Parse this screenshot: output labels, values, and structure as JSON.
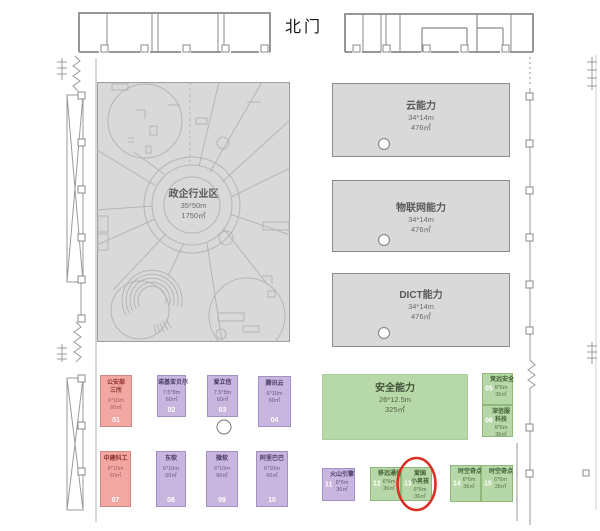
{
  "labels": {
    "north_gate": "北门"
  },
  "zones": {
    "gov": {
      "name": "政企行业区",
      "size": "35*50m",
      "area": "1750㎡"
    },
    "cloud": {
      "name": "云能力",
      "size": "34*14m",
      "area": "476㎡"
    },
    "iot": {
      "name": "物联网能力",
      "size": "34*14m",
      "area": "476㎡"
    },
    "dict": {
      "name": "DICT能力",
      "size": "34*14m",
      "area": "476㎡"
    },
    "security": {
      "name": "安全能力",
      "size": "26*12.5m",
      "area": "325㎡"
    }
  },
  "booths": [
    {
      "num": "01",
      "lines": [
        "公安部",
        "三所"
      ],
      "size": "6*10m",
      "area": "60㎡",
      "color_key": "pink"
    },
    {
      "num": "02",
      "lines": [
        "诺基亚贝尔",
        ""
      ],
      "size": "7.5*8m",
      "area": "60㎡",
      "color_key": "purple"
    },
    {
      "num": "03",
      "lines": [
        "爱立信",
        ""
      ],
      "size": "7.5*8m",
      "area": "60㎡",
      "color_key": "purple"
    },
    {
      "num": "04",
      "lines": [
        "腾讯云",
        ""
      ],
      "size": "6*10m",
      "area": "60㎡",
      "color_key": "purple"
    },
    {
      "num": "05",
      "lines": [
        "竞远安全",
        ""
      ],
      "size": "6*6m",
      "area": "36㎡",
      "color_key": "green"
    },
    {
      "num": "06",
      "lines": [
        "深信服",
        "科技"
      ],
      "size": "6*6m",
      "area": "36㎡",
      "color_key": "green"
    },
    {
      "num": "07",
      "lines": [
        "中建科工",
        ""
      ],
      "size": "6*10m",
      "area": "60㎡",
      "color_key": "pink"
    },
    {
      "num": "08",
      "lines": [
        "东软",
        ""
      ],
      "size": "6*10m",
      "area": "60㎡",
      "color_key": "purple"
    },
    {
      "num": "09",
      "lines": [
        "微软",
        ""
      ],
      "size": "6*10m",
      "area": "60㎡",
      "color_key": "purple"
    },
    {
      "num": "10",
      "lines": [
        "阿里巴巴",
        ""
      ],
      "size": "6*10m",
      "area": "60㎡",
      "color_key": "purple"
    },
    {
      "num": "11",
      "lines": [
        "火山引擎",
        ""
      ],
      "size": "6*6m",
      "area": "36㎡",
      "color_key": "purple"
    },
    {
      "num": "12",
      "lines": [
        "移远通信",
        ""
      ],
      "size": "6*6m",
      "area": "36㎡",
      "color_key": "green"
    },
    {
      "num": "13",
      "lines": [
        "爱国",
        "小男孩"
      ],
      "size": "6*6m",
      "area": "36㎡",
      "color_key": "green",
      "highlighted": true
    },
    {
      "num": "14",
      "lines": [
        "时空奇点",
        ""
      ],
      "size": "6*6m",
      "area": "36㎡",
      "color_key": "green"
    },
    {
      "num": "15",
      "lines": [
        "时空奇点",
        ""
      ],
      "size": "6*6m",
      "area": "36㎡",
      "color_key": "green"
    }
  ],
  "highlight": {
    "booth": "13",
    "color": "#d93025"
  },
  "colors": {
    "booth_pink": "#f3a7a2",
    "booth_purple": "#c8b6de",
    "booth_green": "#b6d7a7",
    "zone_gray": "#d9d9d9",
    "security_green": "#b7d8a8",
    "highlight_red": "#d93025",
    "wall_gray": "#8a8a8a"
  }
}
